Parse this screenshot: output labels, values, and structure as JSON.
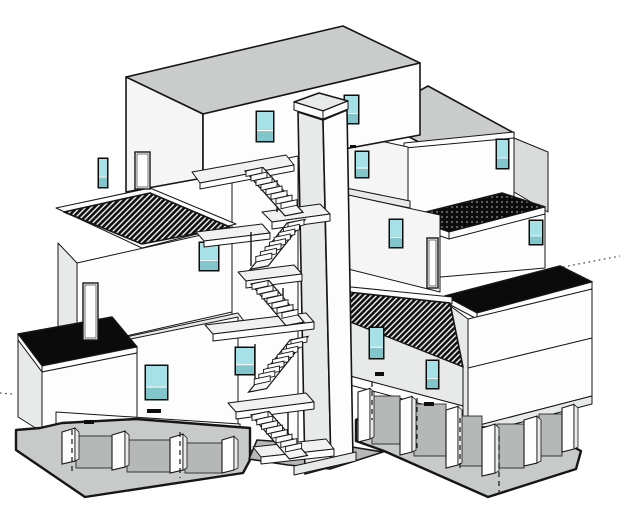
{
  "scene": {
    "description": "Black-and-white axonometric architectural drawing of a stacked modular apartment building with a central elevator tower, external zigzag stairs with landings, teal-glazed windows, flat black and hatched roofs, a dotted roof terrace, open pilotis ground floor on a ground slab, and thin dotted leader lines at left and right edges."
  },
  "colors": {
    "bg": "#ffffff",
    "line": "#161616",
    "wall": "#fdfdfd",
    "wall_light": "#f4f5f4",
    "wall_shade": "#e8eae9",
    "wall_gray": "#d9dcda",
    "roof": "#c9ccca",
    "slab": "#f0f1f0",
    "ground": "#c7cac8",
    "ground_dark": "#b5b8b6",
    "black": "#0b0b0b",
    "glass": "#a5e1e6",
    "glass_dark": "#82c6cc",
    "frame": "#0d0d0d",
    "leader": "#4a4a4a"
  },
  "windows": [
    {
      "x": 257,
      "y": 112,
      "w": 16,
      "h": 29
    },
    {
      "x": 345,
      "y": 96,
      "w": 13,
      "h": 27
    },
    {
      "x": 356,
      "y": 152,
      "w": 12,
      "h": 25
    },
    {
      "x": 390,
      "y": 220,
      "w": 12,
      "h": 27
    },
    {
      "x": 200,
      "y": 243,
      "w": 18,
      "h": 27
    },
    {
      "x": 146,
      "y": 366,
      "w": 21,
      "h": 33
    },
    {
      "x": 236,
      "y": 348,
      "w": 18,
      "h": 26
    },
    {
      "x": 370,
      "y": 328,
      "w": 13,
      "h": 30
    },
    {
      "x": 427,
      "y": 361,
      "w": 11,
      "h": 27
    },
    {
      "x": 497,
      "y": 140,
      "w": 11,
      "h": 28
    },
    {
      "x": 530,
      "y": 221,
      "w": 12,
      "h": 23
    },
    {
      "x": 99,
      "y": 159,
      "w": 8,
      "h": 28
    }
  ],
  "doors": [
    {
      "x": 135,
      "y": 152,
      "w": 15,
      "h": 37
    },
    {
      "x": 83,
      "y": 283,
      "w": 15,
      "h": 57
    },
    {
      "x": 427,
      "y": 238,
      "w": 11,
      "h": 50
    }
  ],
  "vents": [
    {
      "x": 84,
      "y": 420,
      "w": 10,
      "h": 4
    },
    {
      "x": 147,
      "y": 409,
      "w": 14,
      "h": 4
    },
    {
      "x": 375,
      "y": 372,
      "w": 9,
      "h": 4
    },
    {
      "x": 424,
      "y": 402,
      "w": 10,
      "h": 4
    },
    {
      "x": 350,
      "y": 145,
      "w": 6,
      "h": 3
    },
    {
      "x": 272,
      "y": 451,
      "w": 16,
      "h": 4
    }
  ],
  "hidden_edges": [
    {
      "x": 72,
      "y1": 430,
      "y2": 474
    },
    {
      "x": 180,
      "y1": 432,
      "y2": 478
    },
    {
      "x": 372,
      "y1": 382,
      "y2": 420
    },
    {
      "x": 417,
      "y1": 398,
      "y2": 452
    },
    {
      "x": 460,
      "y1": 418,
      "y2": 472
    },
    {
      "x": 499,
      "y1": 436,
      "y2": 492
    }
  ],
  "leader_lines": [
    {
      "x1": 563,
      "y1": 267,
      "x2": 620,
      "y2": 256
    },
    {
      "x1": 0,
      "y1": 393,
      "x2": 12,
      "y2": 394
    }
  ],
  "stairs": {
    "tread": {
      "dx": 16,
      "dy": -3.5,
      "rise": 5.5
    },
    "flights": [
      {
        "x": 246,
        "y": 171,
        "n": 8,
        "sx": 5.0,
        "sy": 4.6
      },
      {
        "x": 288,
        "y": 223,
        "n": 8,
        "sx": -4.6,
        "sy": 4.8
      },
      {
        "x": 252,
        "y": 284,
        "n": 7,
        "sx": 5.0,
        "sy": 4.8
      },
      {
        "x": 291,
        "y": 340,
        "n": 9,
        "sx": -4.6,
        "sy": 4.9
      },
      {
        "x": 252,
        "y": 415,
        "n": 8,
        "sx": 4.8,
        "sy": 4.5
      }
    ]
  },
  "posts": [
    {
      "x": 277,
      "y": 180,
      "len": 32
    },
    {
      "x": 251,
      "y": 232,
      "len": 34
    },
    {
      "x": 283,
      "y": 288,
      "len": 28
    },
    {
      "x": 255,
      "y": 344,
      "len": 38
    },
    {
      "x": 288,
      "y": 412,
      "len": 28
    }
  ],
  "columns": [
    {
      "x": 62,
      "y": 432,
      "w": 13,
      "h": 32
    },
    {
      "x": 112,
      "y": 435,
      "w": 13,
      "h": 35
    },
    {
      "x": 170,
      "y": 438,
      "w": 13,
      "h": 35
    },
    {
      "x": 222,
      "y": 440,
      "w": 12,
      "h": 33
    },
    {
      "x": 358,
      "y": 392,
      "w": 12,
      "h": 50
    },
    {
      "x": 400,
      "y": 400,
      "w": 12,
      "h": 55
    },
    {
      "x": 446,
      "y": 410,
      "w": 12,
      "h": 58
    },
    {
      "x": 482,
      "y": 428,
      "w": 13,
      "h": 48
    },
    {
      "x": 524,
      "y": 420,
      "w": 13,
      "h": 46
    },
    {
      "x": 562,
      "y": 408,
      "w": 12,
      "h": 44
    }
  ],
  "bays": [
    {
      "x": 76,
      "y": 436,
      "w": 36,
      "h": 32
    },
    {
      "x": 127,
      "y": 440,
      "w": 43,
      "h": 32
    },
    {
      "x": 185,
      "y": 443,
      "w": 37,
      "h": 30
    },
    {
      "x": 372,
      "y": 396,
      "w": 28,
      "h": 48
    },
    {
      "x": 414,
      "y": 404,
      "w": 32,
      "h": 52
    },
    {
      "x": 460,
      "y": 416,
      "w": 22,
      "h": 50
    },
    {
      "x": 497,
      "y": 424,
      "w": 27,
      "h": 44
    },
    {
      "x": 539,
      "y": 414,
      "w": 23,
      "h": 42
    }
  ]
}
